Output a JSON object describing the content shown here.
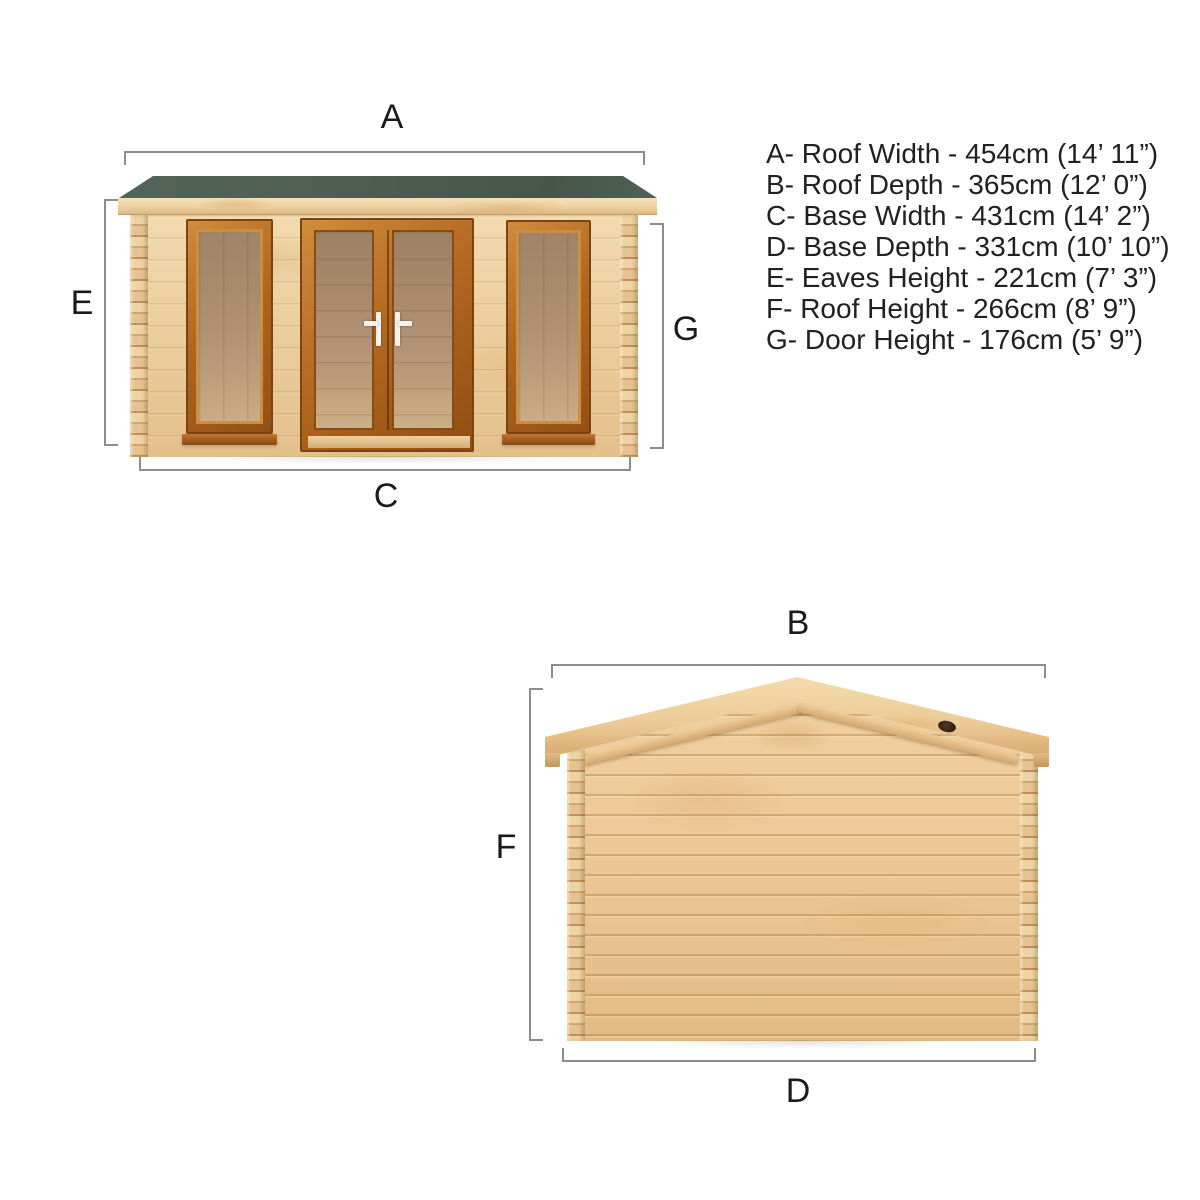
{
  "views": {
    "front": {
      "name": "front elevation",
      "labels": {
        "top": "A",
        "left": "E",
        "right": "G",
        "bottom": "C"
      }
    },
    "side": {
      "name": "side elevation",
      "labels": {
        "top": "B",
        "left": "F",
        "bottom": "D"
      }
    }
  },
  "legend": {
    "items": [
      "A- Roof Width - 454cm (14’ 11”)",
      "B- Roof Depth - 365cm (12’ 0”)",
      "C- Base Width - 431cm (14’ 2”)",
      "D- Base Depth - 331cm (10’ 10”)",
      "E- Eaves Height - 221cm (7’ 3”)",
      "F- Roof Height - 266cm (8’ 9”)",
      "G- Door Height - 176cm (5’ 9”)"
    ]
  },
  "colors": {
    "roof-green": "#4e5c51",
    "frame-orange": "#b2661f",
    "frame-orange-dark": "#7c430f",
    "handle-white": "#f7f3ec",
    "side-wood": "#ecc795",
    "dim-line": "#8d8d8d",
    "label-color": "#1b1b1b",
    "legend-color": "#212121"
  }
}
